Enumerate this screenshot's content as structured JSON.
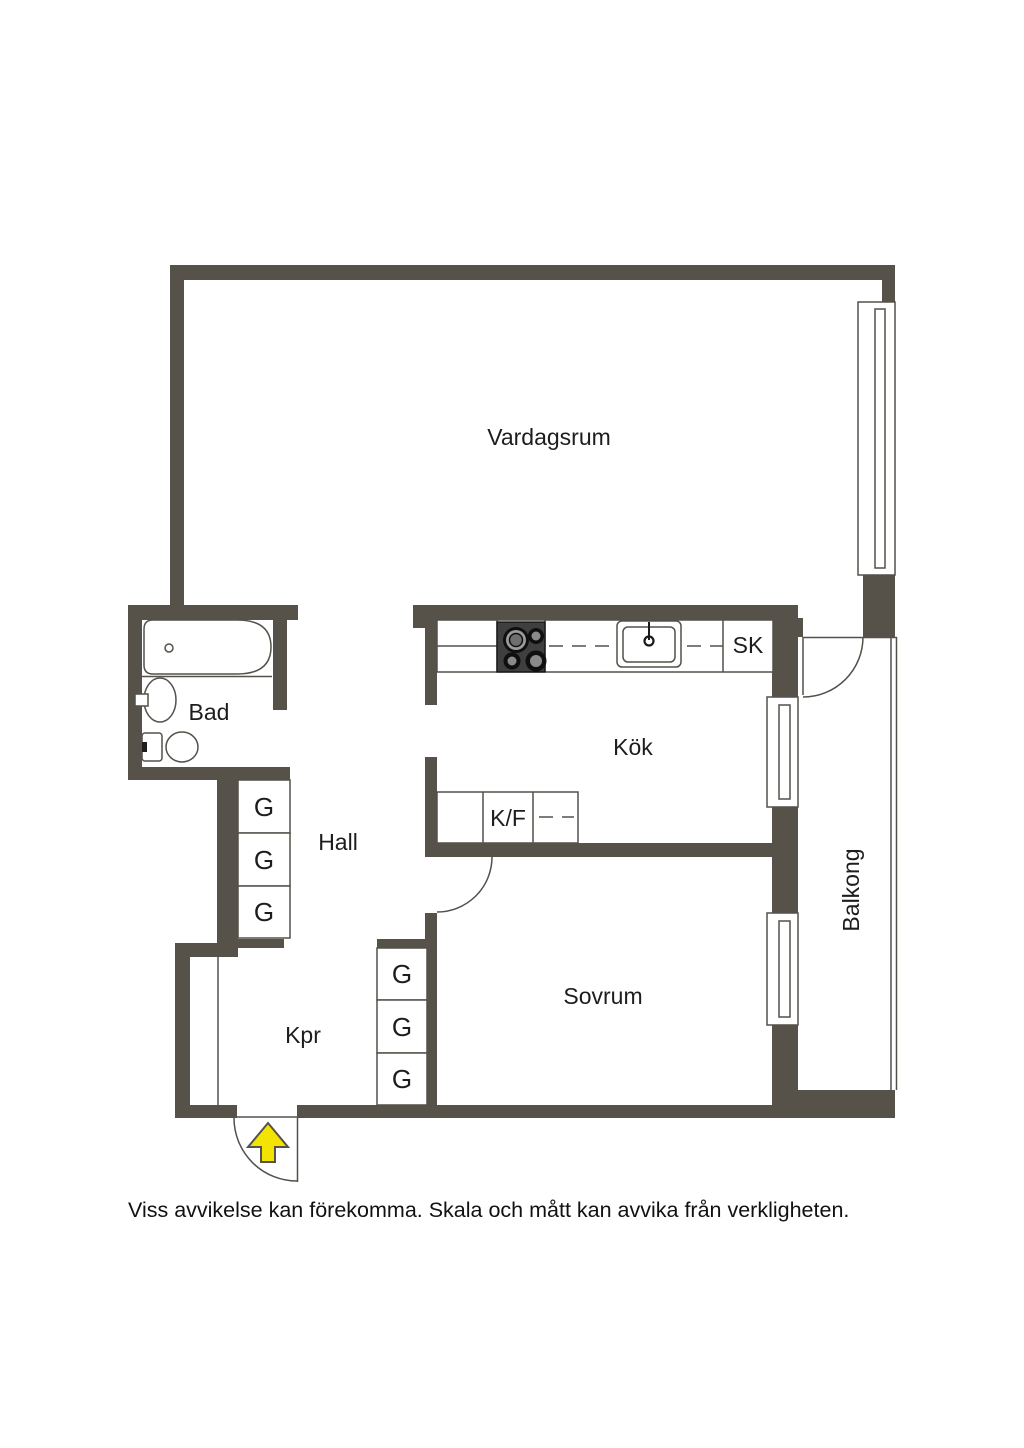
{
  "plan": {
    "labels": {
      "living_room": "Vardagsrum",
      "bathroom": "Bad",
      "kitchen": "Kök",
      "hall": "Hall",
      "closet_room": "Kpr",
      "bedroom": "Sovrum",
      "balcony": "Balkong",
      "wardrobe": "G",
      "cleaning_closet": "SK",
      "fridge_freezer": "K/F"
    },
    "disclaimer": "Viss avvikelse kan förekomma. Skala och mått kan avvika från verkligheten.",
    "colors": {
      "wall": "#56524A",
      "thin_line": "#54504A",
      "entrance_arrow": "#F2E400",
      "stove": "#3F3F3F",
      "background": "#FFFFFF",
      "text": "#1D1D1D"
    }
  }
}
